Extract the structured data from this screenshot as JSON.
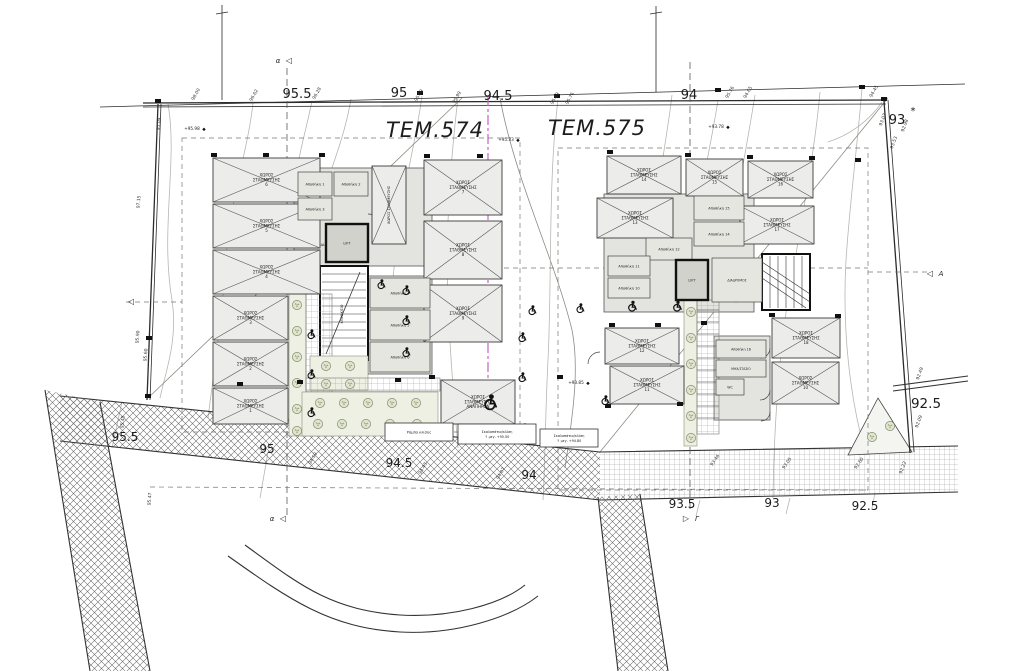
{
  "drawing": {
    "plot_labels": [
      {
        "text": "ΤΕΜ.574",
        "x": 435,
        "y": 137
      },
      {
        "text": "ΤΕΜ.575",
        "x": 597,
        "y": 135
      }
    ],
    "contour_labels": [
      {
        "t": "95.5",
        "x": 297,
        "y": 98,
        "s": 13
      },
      {
        "t": "95",
        "x": 399,
        "y": 97,
        "s": 13
      },
      {
        "t": "94.5",
        "x": 498,
        "y": 100,
        "s": 13
      },
      {
        "t": "94",
        "x": 689,
        "y": 99,
        "s": 13
      },
      {
        "t": "93",
        "x": 897,
        "y": 124,
        "s": 13
      },
      {
        "t": "*",
        "x": 913,
        "y": 114,
        "s": 10
      },
      {
        "t": "95.5",
        "x": 125,
        "y": 441,
        "s": 12
      },
      {
        "t": "95",
        "x": 267,
        "y": 453,
        "s": 12
      },
      {
        "t": "94.5",
        "x": 399,
        "y": 467,
        "s": 12
      },
      {
        "t": "94",
        "x": 529,
        "y": 479,
        "s": 12
      },
      {
        "t": "93.5",
        "x": 682,
        "y": 508,
        "s": 12
      },
      {
        "t": "93",
        "x": 772,
        "y": 507,
        "s": 12
      },
      {
        "t": "92.5",
        "x": 865,
        "y": 510,
        "s": 12
      },
      {
        "t": "92.5",
        "x": 926,
        "y": 408,
        "s": 13.5
      }
    ],
    "tick_labels": [
      {
        "t": "98.00",
        "x": 197,
        "y": 95,
        "r": -60
      },
      {
        "t": "96.62",
        "x": 255,
        "y": 96,
        "r": -60
      },
      {
        "t": "96.28",
        "x": 318,
        "y": 94,
        "r": -60
      },
      {
        "t": "95.09",
        "x": 420,
        "y": 96,
        "r": -60
      },
      {
        "t": "95.99",
        "x": 458,
        "y": 98,
        "r": -60
      },
      {
        "t": "95.89",
        "x": 556,
        "y": 99,
        "r": -60
      },
      {
        "t": "95.76",
        "x": 571,
        "y": 99,
        "r": -60
      },
      {
        "t": "95.76",
        "x": 731,
        "y": 93,
        "r": -60
      },
      {
        "t": "94.65",
        "x": 749,
        "y": 93,
        "r": -60
      },
      {
        "t": "94.45",
        "x": 875,
        "y": 92,
        "r": -60
      },
      {
        "t": "93.07",
        "x": 884,
        "y": 120,
        "r": -70
      },
      {
        "t": "93.53",
        "x": 895,
        "y": 143,
        "r": -70
      },
      {
        "t": "92.98",
        "x": 906,
        "y": 126,
        "r": -70
      },
      {
        "t": "92.49",
        "x": 921,
        "y": 374,
        "r": -70
      },
      {
        "t": "92.09",
        "x": 920,
        "y": 422,
        "r": -70
      },
      {
        "t": "92.22",
        "x": 904,
        "y": 468,
        "r": -70
      },
      {
        "t": "97.15",
        "x": 140,
        "y": 202,
        "r": -85
      },
      {
        "t": "95.04",
        "x": 160,
        "y": 124,
        "r": -85
      },
      {
        "t": "95.90",
        "x": 139,
        "y": 337,
        "r": -85
      },
      {
        "t": "95.60",
        "x": 147,
        "y": 355,
        "r": -85
      },
      {
        "t": "95.45",
        "x": 124,
        "y": 422,
        "r": -85
      },
      {
        "t": "95.47",
        "x": 151,
        "y": 499,
        "r": -85
      },
      {
        "t": "94.59",
        "x": 314,
        "y": 459,
        "r": -60
      },
      {
        "t": "94.43",
        "x": 424,
        "y": 469,
        "r": -60
      },
      {
        "t": "94.07",
        "x": 502,
        "y": 474,
        "r": -60
      },
      {
        "t": "93.46",
        "x": 716,
        "y": 461,
        "r": -55
      },
      {
        "t": "93.05",
        "x": 788,
        "y": 464,
        "r": -55
      },
      {
        "t": "92.60",
        "x": 860,
        "y": 464,
        "r": -55
      }
    ],
    "spot_elevations": [
      {
        "t": "+95.98",
        "x": 192,
        "y": 130
      },
      {
        "t": "+95.33",
        "x": 506,
        "y": 141
      },
      {
        "t": "+93.78",
        "x": 716,
        "y": 128
      },
      {
        "t": "+93.85",
        "x": 576,
        "y": 384
      }
    ],
    "section_markers": [
      {
        "letter": "α",
        "sym": "◁",
        "x": 278,
        "y": 63,
        "after": false
      },
      {
        "letter": "α",
        "sym": "◁",
        "x": 272,
        "y": 521,
        "after": false
      },
      {
        "letter": "Γ",
        "sym": "▷",
        "x": 686,
        "y": 521,
        "after": true
      },
      {
        "letter": "A",
        "sym": "◁",
        "x": 930,
        "y": 276,
        "after": true
      },
      {
        "letter": "",
        "sym": "◁",
        "x": 120,
        "y": 304,
        "after": false
      }
    ],
    "parking_stalls": [
      {
        "x": 213,
        "y": 158,
        "w": 107,
        "h": 44,
        "n": "6"
      },
      {
        "x": 213,
        "y": 204,
        "w": 107,
        "h": 44,
        "n": "5"
      },
      {
        "x": 213,
        "y": 250,
        "w": 107,
        "h": 44,
        "n": "4"
      },
      {
        "x": 213,
        "y": 296,
        "w": 75,
        "h": 44,
        "n": "3"
      },
      {
        "x": 213,
        "y": 342,
        "w": 75,
        "h": 44,
        "n": "2"
      },
      {
        "x": 213,
        "y": 388,
        "w": 75,
        "h": 36,
        "n": "1"
      },
      {
        "x": 424,
        "y": 160,
        "w": 78,
        "h": 55,
        "n": "7"
      },
      {
        "x": 424,
        "y": 221,
        "w": 78,
        "h": 58,
        "n": "8"
      },
      {
        "x": 424,
        "y": 285,
        "w": 78,
        "h": 57,
        "n": "9"
      },
      {
        "x": 372,
        "y": 166,
        "w": 34,
        "h": 78,
        "n": "",
        "vertical": true
      },
      {
        "x": 441,
        "y": 380,
        "w": 74,
        "h": 44,
        "n": "",
        "label2": "ΑΝΑΠΗΡΩΝ"
      },
      {
        "x": 607,
        "y": 156,
        "w": 74,
        "h": 38,
        "n": "14"
      },
      {
        "x": 686,
        "y": 159,
        "w": 57,
        "h": 37,
        "n": "15"
      },
      {
        "x": 748,
        "y": 161,
        "w": 65,
        "h": 37,
        "n": "16"
      },
      {
        "x": 597,
        "y": 198,
        "w": 76,
        "h": 40,
        "n": "13"
      },
      {
        "x": 740,
        "y": 206,
        "w": 74,
        "h": 38,
        "n": "17"
      },
      {
        "x": 605,
        "y": 328,
        "w": 74,
        "h": 36,
        "n": "12"
      },
      {
        "x": 610,
        "y": 366,
        "w": 74,
        "h": 38,
        "n": "11"
      },
      {
        "x": 772,
        "y": 318,
        "w": 68,
        "h": 40,
        "n": "18"
      },
      {
        "x": 772,
        "y": 362,
        "w": 67,
        "h": 42,
        "n": "10"
      }
    ],
    "stall_label": "ΧΩΡΟΣ ΣΤΑΘΜΕΥΣΗΣ",
    "rooms": [
      {
        "x": 298,
        "y": 172,
        "w": 34,
        "h": 24,
        "label": "Αποθήκη 1"
      },
      {
        "x": 334,
        "y": 172,
        "w": 34,
        "h": 24,
        "label": "Αποθήκη 2"
      },
      {
        "x": 298,
        "y": 198,
        "w": 34,
        "h": 22,
        "label": "Αποθήκη 3"
      },
      {
        "x": 332,
        "y": 246,
        "w": 0,
        "h": 0,
        "label": "ΔΙΑΔΡΟΜΟΣ",
        "fs": 3.8
      },
      {
        "x": 326,
        "y": 224,
        "w": 42,
        "h": 38,
        "label": "LIFT",
        "lift": true
      },
      {
        "x": 370,
        "y": 278,
        "w": 60,
        "h": 30,
        "label": "Αποθήκη 4"
      },
      {
        "x": 370,
        "y": 310,
        "w": 60,
        "h": 30,
        "label": "Αποθήκη 5"
      },
      {
        "x": 370,
        "y": 342,
        "w": 60,
        "h": 30,
        "label": "Αποθήκη 6"
      },
      {
        "x": 343,
        "y": 314,
        "w": 0,
        "h": 0,
        "label": "ΚΛΙΜΑΚ/ΣΙΟ",
        "fs": 3.2,
        "rot": -90
      },
      {
        "x": 694,
        "y": 196,
        "w": 50,
        "h": 24,
        "label": "Αποθήκη 15"
      },
      {
        "x": 694,
        "y": 222,
        "w": 50,
        "h": 24,
        "label": "Αποθήκη 14"
      },
      {
        "x": 646,
        "y": 238,
        "w": 46,
        "h": 22,
        "label": "Αποθήκη 12"
      },
      {
        "x": 608,
        "y": 256,
        "w": 42,
        "h": 20,
        "label": "Αποθήκη 11"
      },
      {
        "x": 608,
        "y": 278,
        "w": 42,
        "h": 20,
        "label": "Αποθήκη 10"
      },
      {
        "x": 676,
        "y": 260,
        "w": 32,
        "h": 40,
        "label": "LIFT",
        "lift": true
      },
      {
        "x": 712,
        "y": 258,
        "w": 50,
        "h": 44,
        "label": "ΔΙΑΔΡΟΜΟΣ",
        "fs": 3.2
      },
      {
        "x": 716,
        "y": 340,
        "w": 50,
        "h": 18,
        "label": "Αποθήκη 16",
        "fs": 3.3
      },
      {
        "x": 716,
        "y": 360,
        "w": 50,
        "h": 17,
        "label": "ΜΗΧ/ΣΤΑΣΙΟ",
        "fs": 3.1
      },
      {
        "x": 716,
        "y": 379,
        "w": 28,
        "h": 16,
        "label": "WC",
        "fs": 3.3
      }
    ],
    "label_boxes": [
      {
        "x": 385,
        "y": 423,
        "w": 68,
        "h": 18,
        "line1": "Ράμπα κλίσης",
        "line2": ""
      },
      {
        "x": 458,
        "y": 424,
        "w": 78,
        "h": 20,
        "line1": "Σκαλοπάτια/κλίση",
        "line2": "↑ μεγ. +95.50"
      },
      {
        "x": 540,
        "y": 429,
        "w": 58,
        "h": 18,
        "line1": "Σκαλοπάτια/κλίση",
        "line2": "↑ μεγ. +94.80"
      }
    ],
    "trees": [
      [
        297,
        305
      ],
      [
        297,
        331
      ],
      [
        297,
        357
      ],
      [
        297,
        383
      ],
      [
        297,
        409
      ],
      [
        297,
        431
      ],
      [
        326,
        366
      ],
      [
        350,
        366
      ],
      [
        326,
        384
      ],
      [
        350,
        384
      ],
      [
        320,
        403
      ],
      [
        344,
        403
      ],
      [
        368,
        403
      ],
      [
        392,
        403
      ],
      [
        416,
        403
      ],
      [
        318,
        424
      ],
      [
        342,
        424
      ],
      [
        366,
        424
      ],
      [
        390,
        424
      ],
      [
        417,
        424
      ],
      [
        691,
        312
      ],
      [
        691,
        338
      ],
      [
        691,
        364
      ],
      [
        691,
        390
      ],
      [
        691,
        416
      ],
      [
        691,
        438
      ],
      [
        872,
        437
      ],
      [
        890,
        426
      ]
    ],
    "wheelchairs": [
      [
        381,
        284,
        10
      ],
      [
        406,
        290,
        10
      ],
      [
        406,
        320,
        10
      ],
      [
        406,
        352,
        10
      ],
      [
        311,
        334,
        10
      ],
      [
        311,
        374,
        10
      ],
      [
        311,
        412,
        10
      ],
      [
        490,
        402,
        16
      ],
      [
        532,
        310,
        10
      ],
      [
        580,
        308,
        10
      ],
      [
        522,
        337,
        10
      ],
      [
        522,
        377,
        10
      ],
      [
        524,
        428,
        10
      ],
      [
        632,
        306,
        11
      ],
      [
        677,
        306,
        11
      ],
      [
        605,
        400,
        10
      ]
    ],
    "corner_ticks": [
      [
        266,
        155
      ],
      [
        322,
        155
      ],
      [
        427,
        156
      ],
      [
        480,
        156
      ],
      [
        214,
        155
      ],
      [
        610,
        152
      ],
      [
        688,
        155
      ],
      [
        750,
        157
      ],
      [
        812,
        158
      ],
      [
        858,
        160
      ],
      [
        240,
        384
      ],
      [
        300,
        382
      ],
      [
        398,
        380
      ],
      [
        432,
        377
      ],
      [
        560,
        377
      ],
      [
        612,
        325
      ],
      [
        658,
        325
      ],
      [
        704,
        323
      ],
      [
        772,
        315
      ],
      [
        838,
        316
      ],
      [
        608,
        406
      ],
      [
        680,
        404
      ],
      [
        158,
        101
      ],
      [
        420,
        93
      ],
      [
        557,
        96
      ],
      [
        718,
        90
      ],
      [
        862,
        87
      ],
      [
        884,
        99
      ],
      [
        149,
        338
      ],
      [
        148,
        396
      ]
    ],
    "colors": {
      "magenta_line": "#c95fc9",
      "contour": "#b6b6b0",
      "building_fill": "#e3e3df",
      "tree_fill": "#dfe5cf",
      "ink": "#2c2c2c"
    }
  }
}
